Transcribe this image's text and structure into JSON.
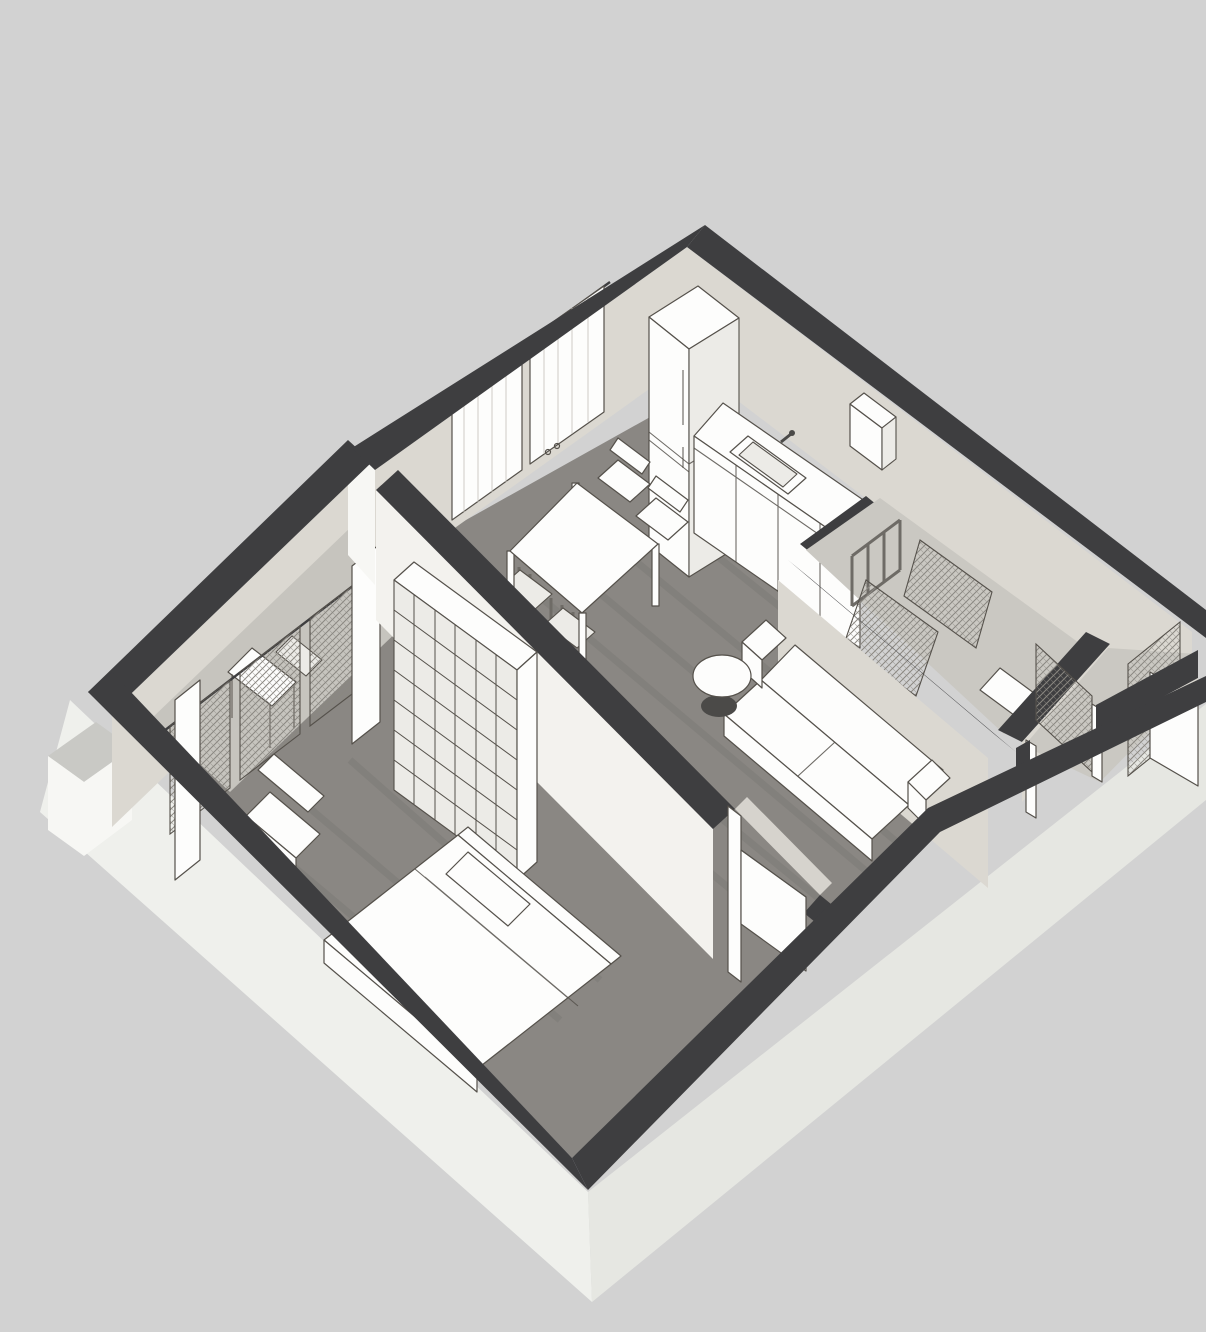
{
  "scene": {
    "title": "3D isometric floor plan of a one-bedroom apartment, grayscale architectural render",
    "projection": "isometric-perspective top view",
    "background": "plain light gray"
  },
  "colors": {
    "background": "#d2d2d2",
    "slab_left": "#eff0ec",
    "slab_right": "#e6e7e2",
    "slab_block_top": "#c9c9c5",
    "wall_top": "#3e3e40",
    "wall_outer": "#f7f7f4",
    "wall_inner": "#dbd8d1",
    "wall_inner_bright": "#f3f2ee",
    "wood": "#8a8783",
    "wood_streak": "#5f5d59",
    "floor_light": "#cac8c2",
    "floor_alcove": "#c6c4be",
    "furniture": "#fdfdfc",
    "furniture_shade": "#ecebe7",
    "outline": "#55514b",
    "fold_line": "#c2bfb8",
    "lamp_base": "#4b4a48",
    "chair_dark": "#6e6b66",
    "hatch_line": "#8a8781",
    "door_sill": "#d6d3cd"
  },
  "rooms": [
    {
      "name": "kitchen-dining",
      "furniture": [
        "fridge",
        "kitchen-counter",
        "sink",
        "wall-cabinet",
        "window-curtains",
        "dining-table",
        "dining-chairs"
      ]
    },
    {
      "name": "living-area",
      "furniture": [
        "sofa",
        "floor-lamp"
      ]
    },
    {
      "name": "bedroom",
      "furniture": [
        "double-bed",
        "bookshelf",
        "armchair",
        "bedroom-door"
      ]
    },
    {
      "name": "balcony-alcove",
      "furniture": [
        "sheer-curtains",
        "small-table",
        "french-doors"
      ]
    },
    {
      "name": "bathroom",
      "furniture": [
        "shower-screen",
        "towel-rail",
        "washbasin",
        "boiler-cabinet"
      ]
    },
    {
      "name": "hallway",
      "furniture": [
        "glazed-doors",
        "entry-door"
      ]
    }
  ]
}
